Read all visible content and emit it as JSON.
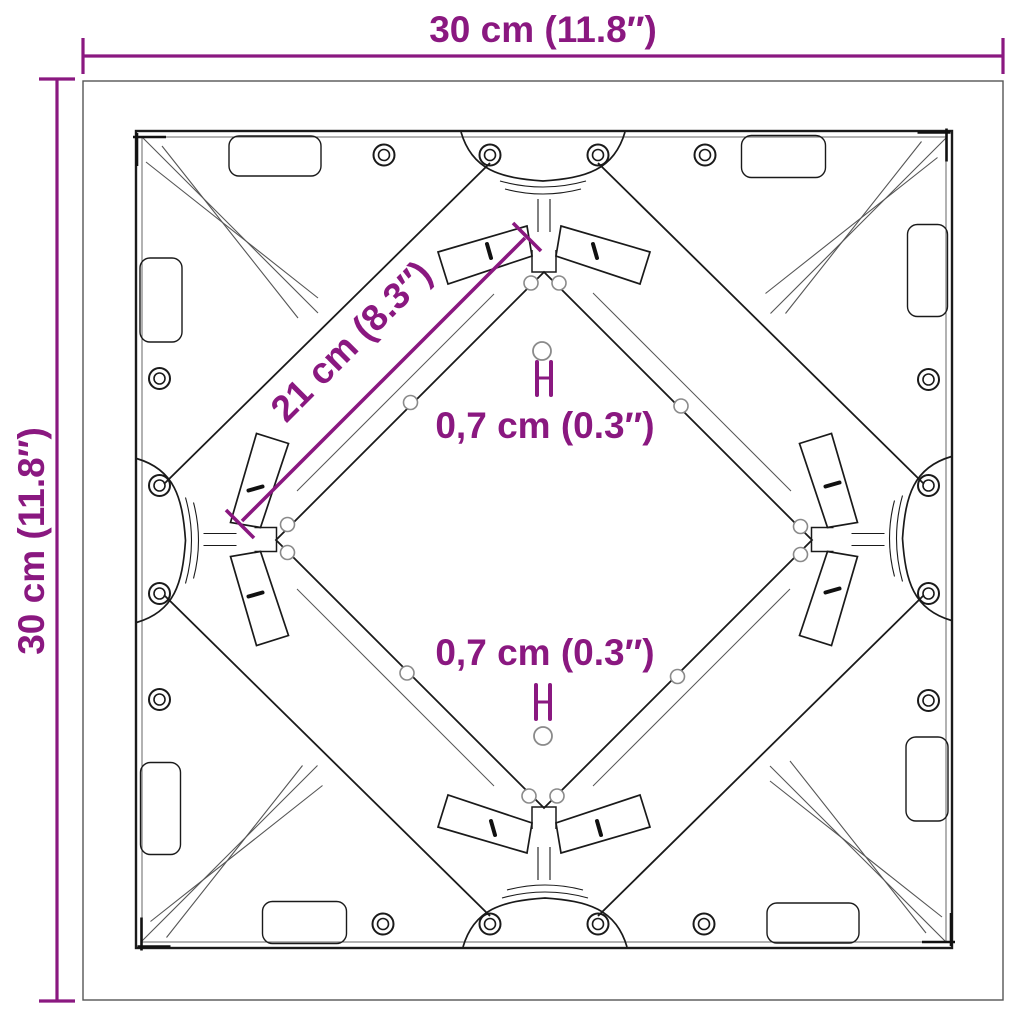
{
  "diagram": {
    "dimensions": {
      "width_label": "30 cm (11.8″)",
      "height_label": "30 cm (11.8″)",
      "diagonal_label": "21 cm (8.3″)",
      "hole_top_label": "0,7 cm (0.3″)",
      "hole_bottom_label": "0,7 cm (0.3″)"
    },
    "colors": {
      "dimension_annotation": "#8A1880",
      "drawing_line": "#1a1a1a",
      "thin_line": "#555555",
      "background": "#ffffff"
    }
  }
}
